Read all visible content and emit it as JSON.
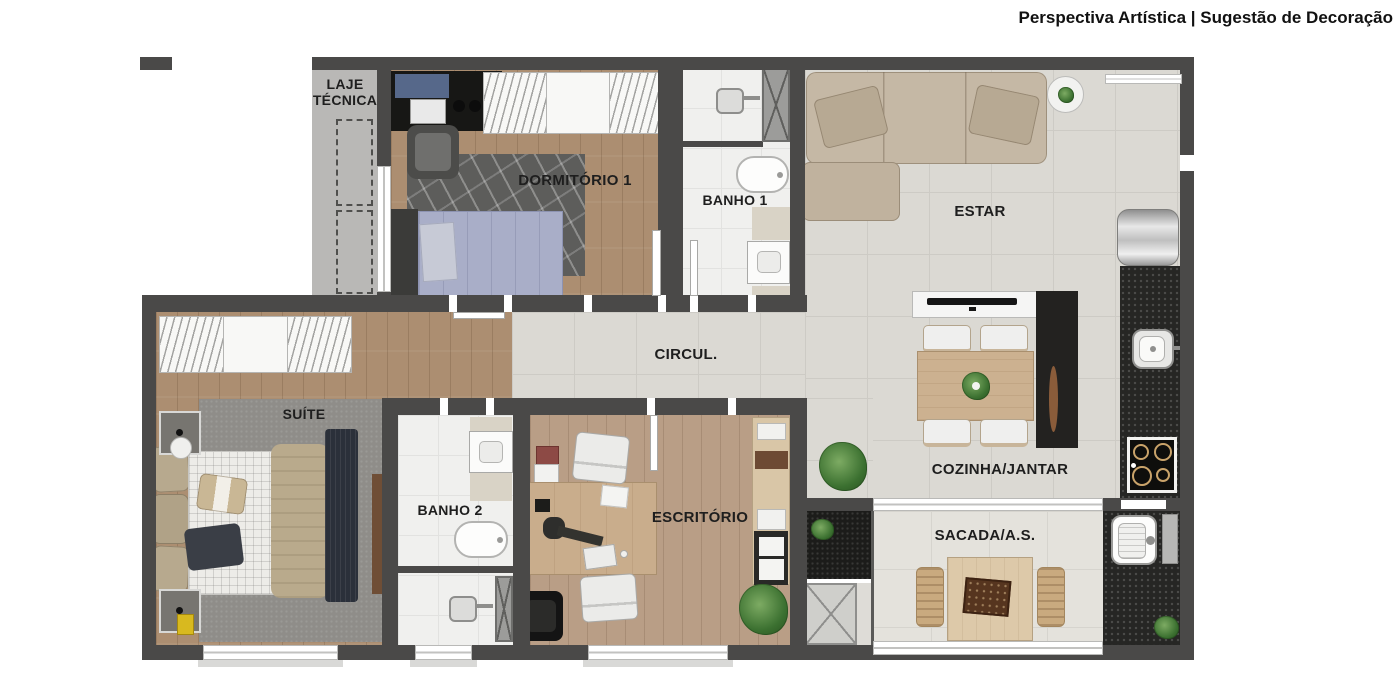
{
  "header": {
    "caption": "Perspectiva Artística | Sugestão de Decoração"
  },
  "rooms": {
    "laje_tecnica": {
      "label": "LAJE TÉCNICA"
    },
    "dormitorio_1": {
      "label": "DORMITÓRIO 1"
    },
    "banho_1": {
      "label": "BANHO 1"
    },
    "estar": {
      "label": "ESTAR"
    },
    "circulacao": {
      "label": "CIRCUL."
    },
    "suite": {
      "label": "SUÍTE"
    },
    "banho_2": {
      "label": "BANHO 2"
    },
    "escritorio": {
      "label": "ESCRITÓRIO"
    },
    "cozinha_jantar": {
      "label": "COZINHA/JANTAR"
    },
    "sacada_as": {
      "label": "SACADA/A.S."
    }
  },
  "colors": {
    "wall": "#4A4948",
    "wood_floor": "#AC8E71",
    "wood_floor_light": "#B99E86",
    "tile_floor": "#DBD9D3",
    "balcony_floor": "#E4E2DC",
    "laje_floor": "#B9B8B6",
    "counter_granite": "#262624",
    "sofa_beige": "#C5B8A5",
    "table_wood": "#CCB190",
    "bed_lavender": "#A9AEC8",
    "plant_green": "#3E7D34"
  },
  "furniture_icons": [
    "sofa",
    "side-table",
    "refrigerator",
    "kitchen-counter",
    "kitchen-sink",
    "cooktop",
    "tv-console",
    "dining-table",
    "dining-chair",
    "tall-cabinet",
    "bed",
    "rug",
    "wardrobe",
    "desk",
    "office-chair",
    "toilet",
    "bathroom-sink",
    "shower",
    "laundry-tub",
    "balcony-table",
    "balcony-chair",
    "ac-condenser",
    "plant",
    "shaft",
    "planter"
  ]
}
